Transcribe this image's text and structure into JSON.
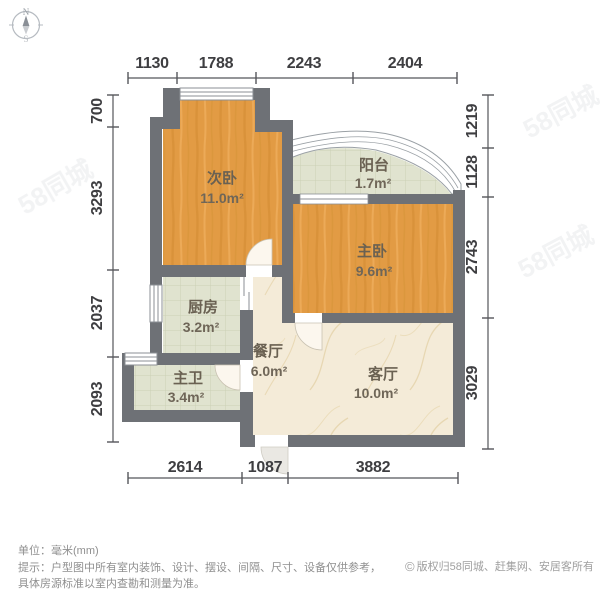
{
  "compass": {
    "north": "N",
    "south": "S"
  },
  "rooms": {
    "bedroom2": {
      "name": "次卧",
      "area": "11.0m²"
    },
    "balcony": {
      "name": "阳台",
      "area": "1.7m²"
    },
    "master_bedroom": {
      "name": "主卧",
      "area": "9.6m²"
    },
    "kitchen": {
      "name": "厨房",
      "area": "3.2m²"
    },
    "dining": {
      "name": "餐厅",
      "area": "6.0m²"
    },
    "master_bath": {
      "name": "主卫",
      "area": "3.4m²"
    },
    "living": {
      "name": "客厅",
      "area": "10.0m²"
    }
  },
  "dimensions_mm": {
    "top": [
      "1130",
      "1788",
      "2243",
      "2404"
    ],
    "left": [
      "700",
      "3293",
      "2037",
      "2093"
    ],
    "right": [
      "1219",
      "1128",
      "2743",
      "3029"
    ],
    "bottom": [
      "2614",
      "1087",
      "3882"
    ]
  },
  "watermark": {
    "text": "58同城"
  },
  "footer": {
    "unit_line": "单位：毫米(mm)",
    "tip_line1": "提示：户型图中所有室内装饰、设计、摆设、间隔、尺寸、设备仅供参考，",
    "tip_line2": "具体房源标准以室内查勘和测量为准。",
    "copyright_symbol": "©",
    "copyright": "版权归58同城、赶集网、安居客所有"
  },
  "colors": {
    "wall": "#6e7176",
    "wood": "#e29b44",
    "tile": "#e0e3cf",
    "marble": "#f4ebd8"
  }
}
